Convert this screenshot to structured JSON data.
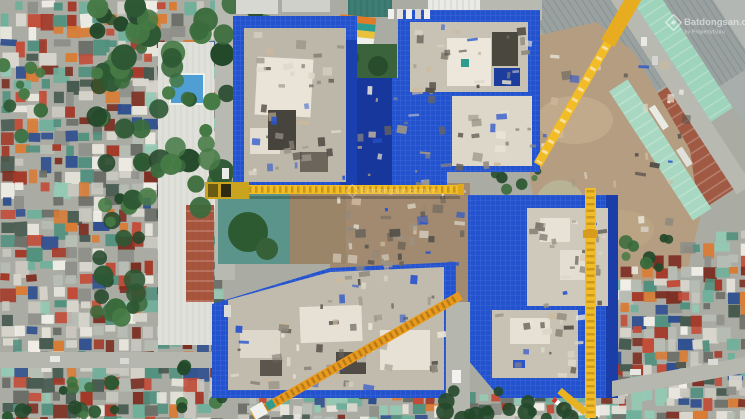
{
  "meta": {
    "title": "Aerial drone photo of apartment construction site",
    "view": "top-down",
    "width_px": 745,
    "height_px": 419
  },
  "watermarks": {
    "top_right": {
      "brand": "Batdongsan.com.vn",
      "byline": "by PropertyGuru",
      "logo": "diamond-logo"
    },
    "center": {
      "brand": "Batdongsan.com.vn"
    }
  },
  "scene": {
    "description": "Top-down drone photograph of a large residential construction project: four tower-block footprints wrapped in bright blue safety netting around a central brown work court, with one horizontal, one vertical and two diagonal yellow tower cranes. Dense low-rise rooftops and trees lie to the west and south, industrial warehouses, a vacant tan dirt lot and diagonal roads to the east, and high-rise towers with a striped amenity canopy to the north.",
    "site": {
      "blocks": [
        "block-a-north-west",
        "block-b-north-east",
        "block-c-south-east",
        "block-d-south-west"
      ],
      "wrap": "blue safety netting",
      "cranes": 4
    },
    "surroundings": {
      "west": "dense low-rise residential rooftops, street trees, long white warehouse with rust roof and small blue pool",
      "east": "corrugated warehouse roofs, vacant dirt lot with long mint-green shed, diagonal road",
      "south": "residential rooftops, palms and a cross street",
      "north": "white high-rise, teal glass tower, striped kindergarten canopy and lawn"
    }
  },
  "colors": {
    "base_gray": "#aaaca4",
    "netting_blue": "#2352cf",
    "netting_dark": "#18379c",
    "netting_light": "#3f6fe8",
    "slab_gray": "#c1bbad",
    "slab_white": "#e9e4d7",
    "slab_dark": "#4e4a43",
    "crane_yellow": "#f2bc26",
    "crane_orange": "#e89a1e",
    "crane_red": "#d0342c",
    "dirt_tan": "#b59d81",
    "dirt_light": "#cdb99c",
    "road_gray": "#b5b7af",
    "tree_green": "#2e5a33",
    "palm_green": "#24482a",
    "lawn_green": "#3a633c",
    "pool_blue": "#4f9fd4",
    "courtyard_teal": "#5a948a",
    "warehouse_gray": "#9aa1a1",
    "mint_roof": "#9ed3bc",
    "rust_roof": "#a05a44",
    "roof_palette": [
      "#e8e5dc",
      "#d9d6cd",
      "#c9c7bf",
      "#94c9b4",
      "#6fb09b",
      "#52907e",
      "#a43828",
      "#c24c38",
      "#7c2e22",
      "#8e9089",
      "#6b6e67",
      "#d97c35",
      "#2f4f8f",
      "#b7bdb4",
      "#f0eee7",
      "#475a50"
    ],
    "tree_palette": [
      "#2d5833",
      "#3a6b3c",
      "#24482a",
      "#467a45"
    ],
    "debris_palette": [
      "#e9e4d7",
      "#dcd6c8",
      "#8e887c",
      "#55514a",
      "#9a9488",
      "#6b655c",
      "#2a55cc",
      "#cdb99c"
    ]
  }
}
